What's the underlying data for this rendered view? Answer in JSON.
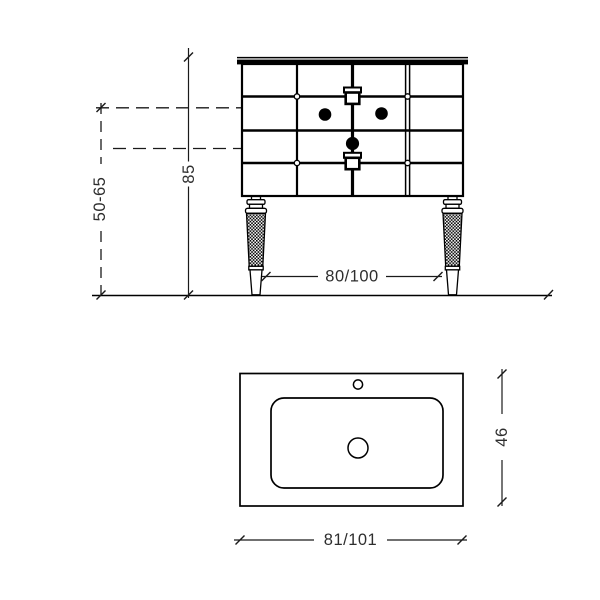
{
  "drawing": {
    "background_color": "#ffffff",
    "line_color": "#000000",
    "text_color": "#2e2e2e",
    "front_view": {
      "dim_overall_height": "85",
      "dim_height_range": "50-65",
      "dim_leg_spacing": "80/100"
    },
    "top_view": {
      "dim_width": "81/101",
      "dim_depth": "46"
    }
  }
}
